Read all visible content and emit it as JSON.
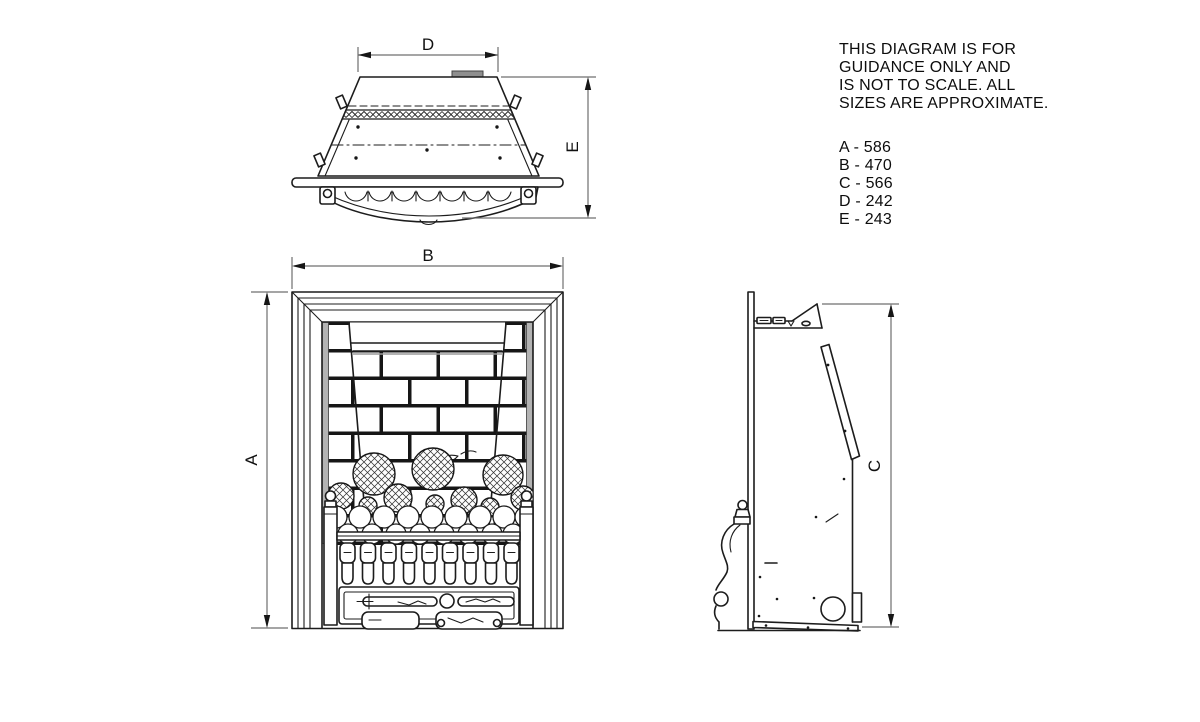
{
  "note": {
    "lines": [
      "THIS DIAGRAM IS FOR",
      "GUIDANCE ONLY AND",
      "IS NOT TO SCALE. ALL",
      "SIZES ARE APPROXIMATE."
    ]
  },
  "dimensions": {
    "items": [
      {
        "label": "A",
        "value": "586",
        "display": "A - 586"
      },
      {
        "label": "B",
        "value": "470",
        "display": "B - 470"
      },
      {
        "label": "C",
        "value": "566",
        "display": "C - 566"
      },
      {
        "label": "D",
        "value": "242",
        "display": "D - 242"
      },
      {
        "label": "E",
        "value": "243",
        "display": "E - 243"
      }
    ]
  },
  "drawing": {
    "labels": {
      "a": "A",
      "b": "B",
      "c": "C",
      "d": "D",
      "e": "E"
    },
    "colors": {
      "line": "#1c1c1c",
      "dim_line": "#6f6f6f",
      "shade": "#b3b3b3"
    }
  }
}
